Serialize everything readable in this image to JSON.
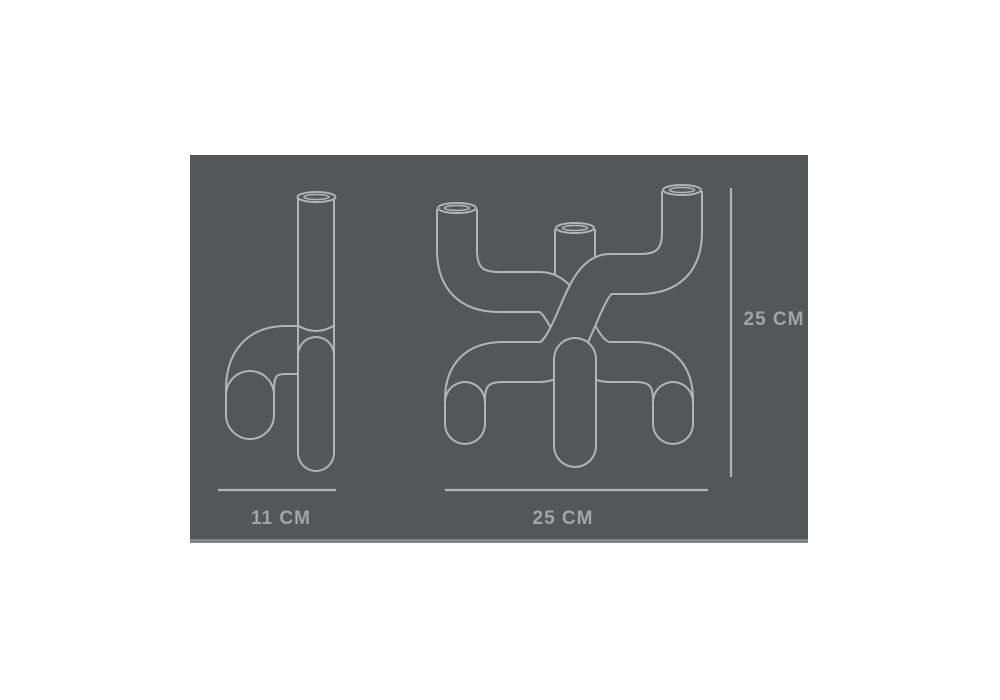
{
  "theme": {
    "page_bg": "#ffffff",
    "panel_bg": "#54565a",
    "line_color": "#b3b4b6",
    "text_color": "#a2a4a6",
    "panel_edge": "#8a8c8e"
  },
  "diagram": {
    "side_view": {
      "width_label": "11 CM"
    },
    "front_view": {
      "width_label": "25 CM",
      "height_label": "25 CM"
    }
  }
}
